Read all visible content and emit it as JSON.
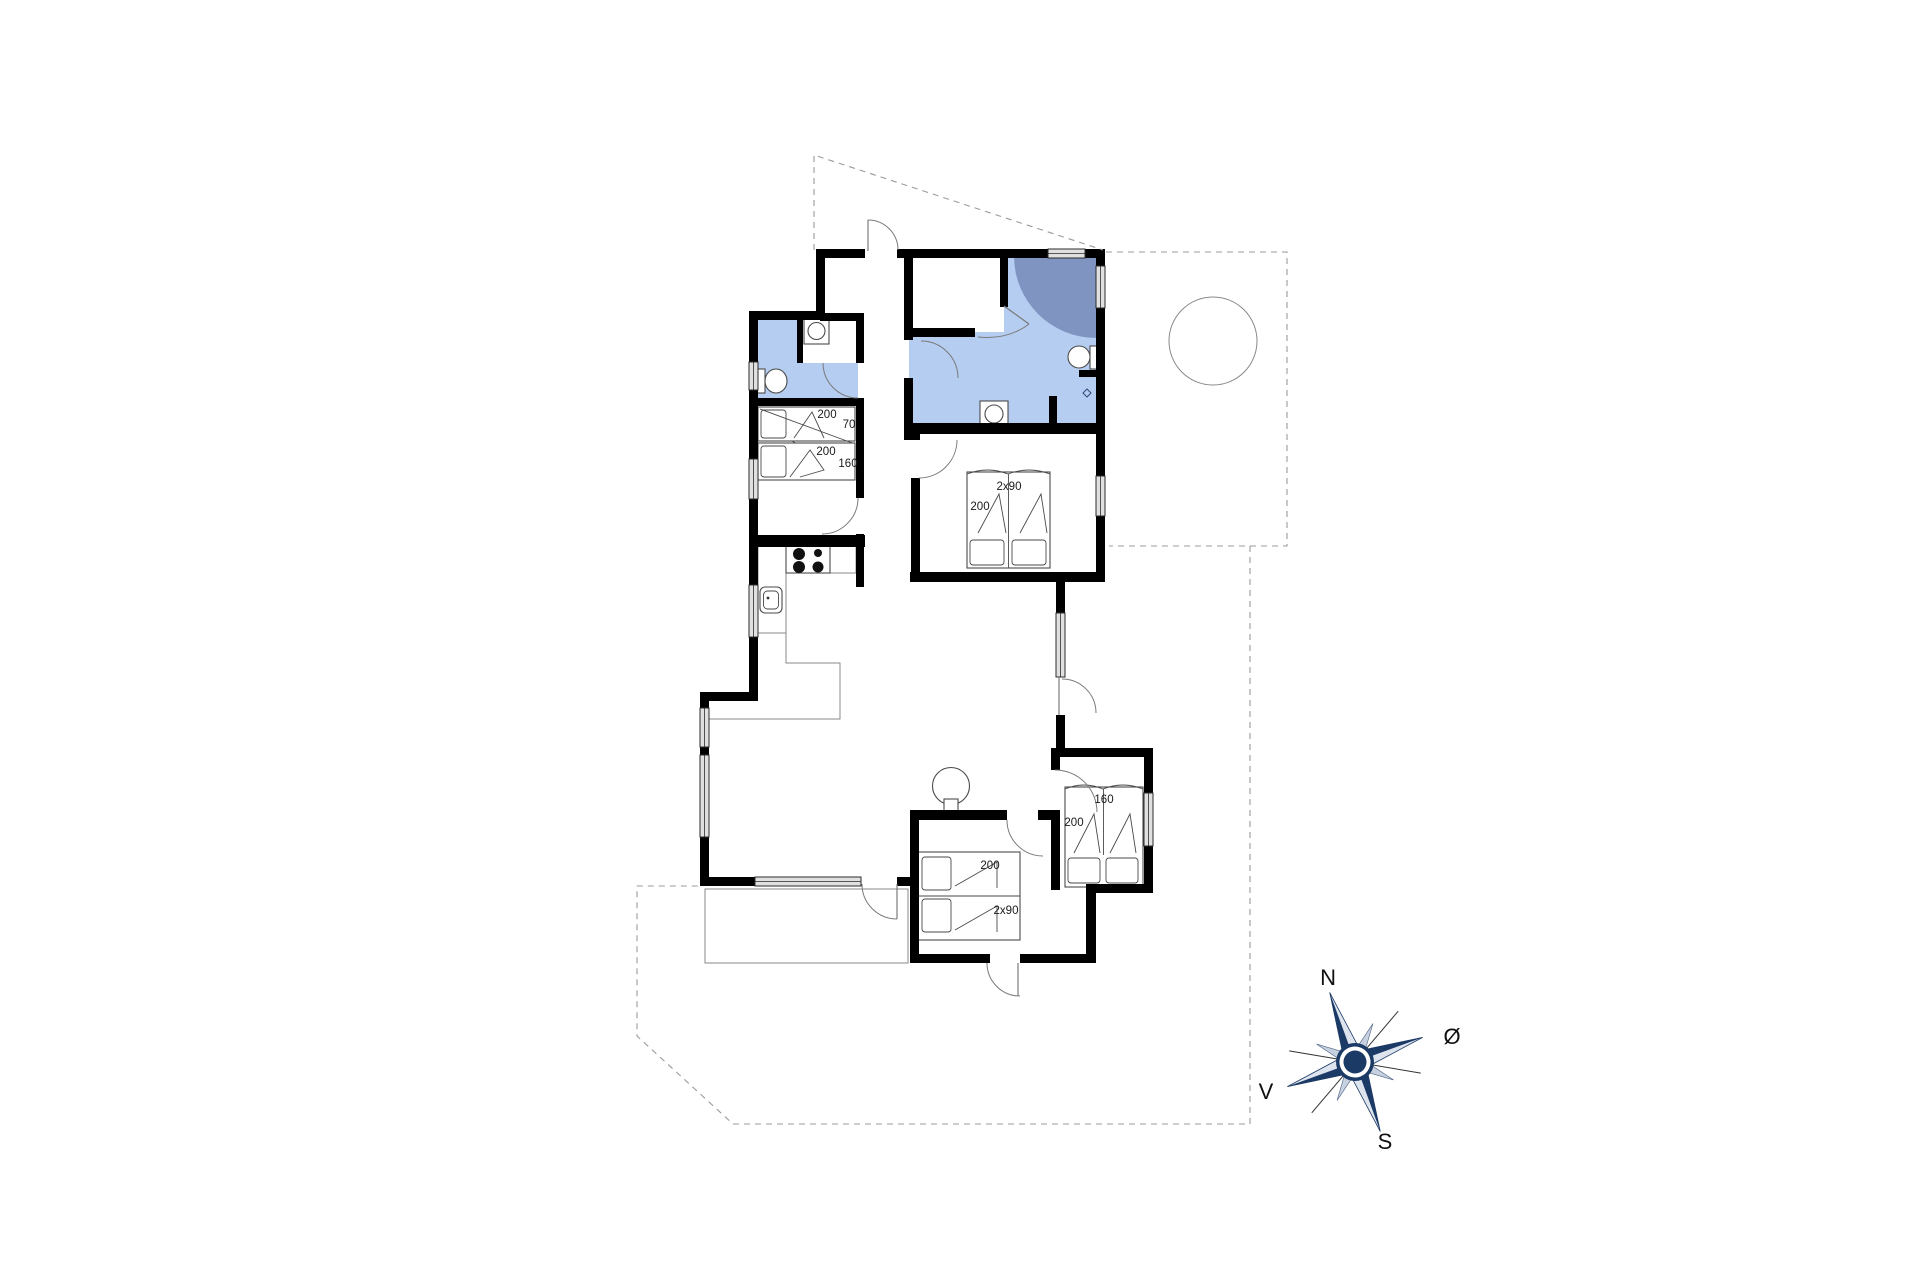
{
  "plan": {
    "beds": {
      "nw_upper": {
        "length": "200",
        "width": "70"
      },
      "nw_lower": {
        "length": "200",
        "width": "160"
      },
      "east": {
        "width": "2x90",
        "length": "200"
      },
      "southeast": {
        "width": "160",
        "length": "200"
      },
      "south": {
        "length": "200",
        "width": "2x90"
      }
    },
    "compass": {
      "north": "N",
      "east": "Ø",
      "south": "S",
      "west": "V"
    },
    "colors": {
      "wall": "#000000",
      "wet_room": "#b5cdf0",
      "shower_corner": "#8094c2",
      "window_fill": "#e0e0e0",
      "compass_navy": "#1c3a66",
      "compass_light": "#dde4ee",
      "compass_mid": "#c6d0de"
    }
  }
}
